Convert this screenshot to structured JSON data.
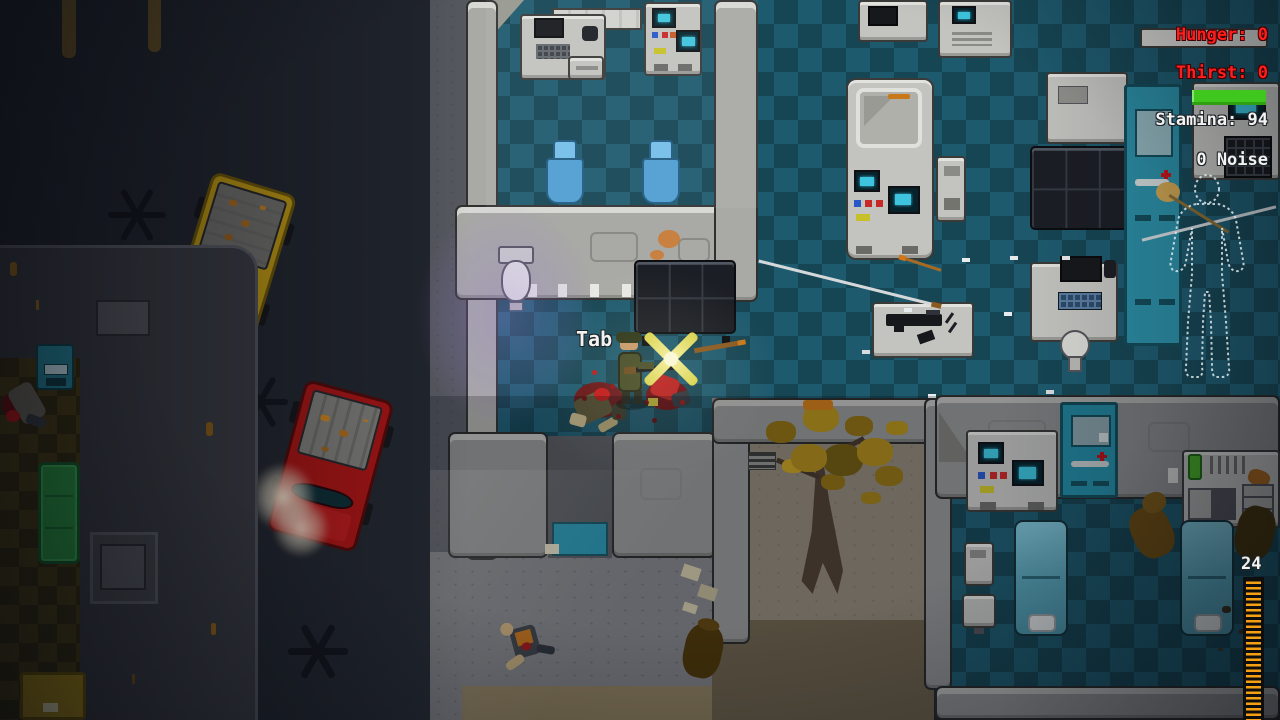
{
  "hud": {
    "hunger": "Hunger: 0",
    "thirst": "Thirst: 0",
    "stamina": "Stamina: 94",
    "stamina_value": 94,
    "noise": "0 Noise",
    "ammo_count": "24",
    "key_prompt": "Tab",
    "colors": {
      "warning_red": "#ff1e1e",
      "stamina_green": "#3fc71e",
      "ammo_orange": "#f5a012",
      "hud_white": "#f2f2f2"
    }
  }
}
